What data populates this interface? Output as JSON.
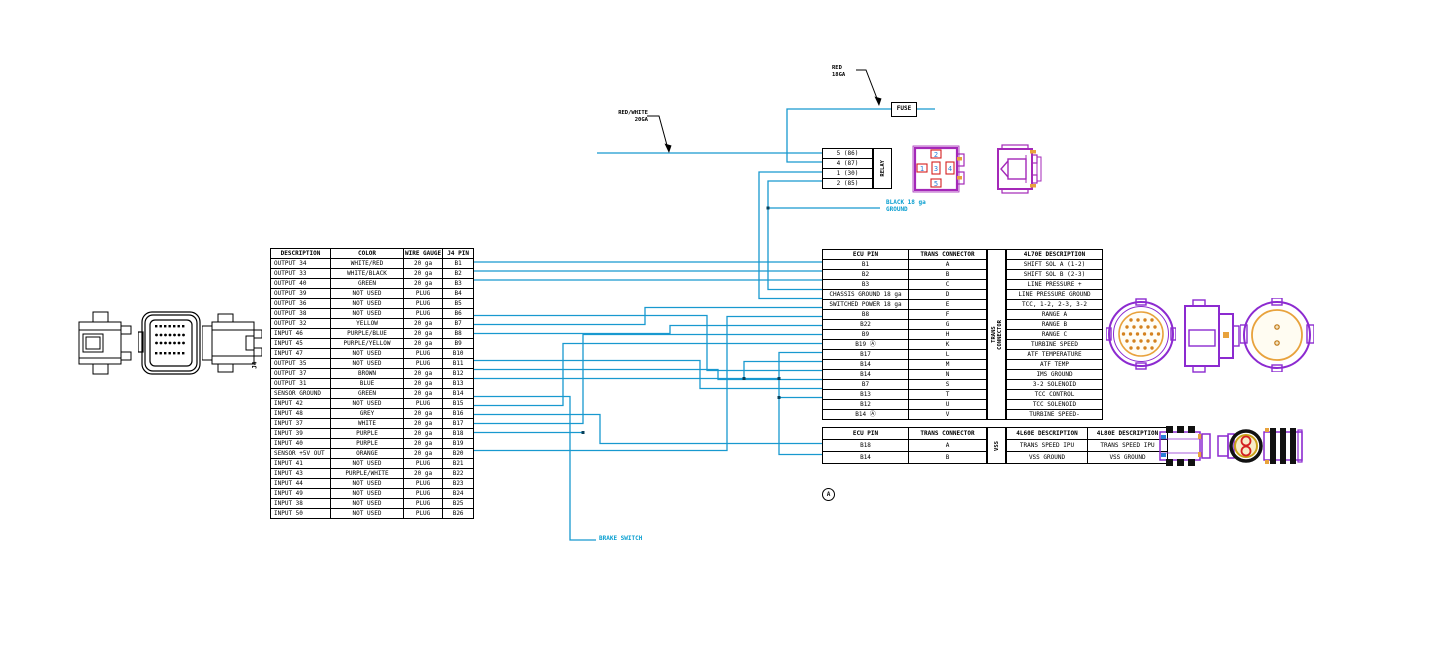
{
  "colors": {
    "wire_cyan": "#1899cf",
    "text_cyan": "#0a9fd0",
    "connector_purple": "#8c2ad0",
    "connector_magenta": "#a428b8",
    "accent_orange": "#e8a23c",
    "pin_red": "#d42020",
    "pin_blue": "#2b7fd8",
    "line_black": "#000000"
  },
  "labels": {
    "fuse": "FUSE",
    "relay": "RELAY",
    "brake_switch": "BRAKE SWITCH",
    "red_wire": "RED\n18GA",
    "red_white_wire": "RED/WHITE\n20GA",
    "ground": "BLACK 18 ga\nGROUND",
    "note_a": "A",
    "j4_label": "J4"
  },
  "relay": {
    "label": "RELAY",
    "rows": [
      [
        "5 (86)"
      ],
      [
        "4 (87)"
      ],
      [
        "1 (30)"
      ],
      [
        "2 (85)"
      ]
    ],
    "socket_pin_numbers": [
      "1",
      "2",
      "3",
      "4",
      "5"
    ]
  },
  "j4_table": {
    "headers": [
      "DESCRIPTION",
      "COLOR",
      "WIRE GAUGE",
      "J4 PIN"
    ],
    "rows": [
      [
        "OUTPUT 34",
        "WHITE/RED",
        "20 ga",
        "B1"
      ],
      [
        "OUTPUT 33",
        "WHITE/BLACK",
        "20 ga",
        "B2"
      ],
      [
        "OUTPUT 40",
        "GREEN",
        "20 ga",
        "B3"
      ],
      [
        "OUTPUT 39",
        "NOT USED",
        "PLUG",
        "B4"
      ],
      [
        "OUTPUT 36",
        "NOT USED",
        "PLUG",
        "B5"
      ],
      [
        "OUTPUT 38",
        "NOT USED",
        "PLUG",
        "B6"
      ],
      [
        "OUTPUT 32",
        "YELLOW",
        "20 ga",
        "B7"
      ],
      [
        "INPUT 46",
        "PURPLE/BLUE",
        "20 ga",
        "B8"
      ],
      [
        "INPUT 45",
        "PURPLE/YELLOW",
        "20 ga",
        "B9"
      ],
      [
        "INPUT 47",
        "NOT USED",
        "PLUG",
        "B10"
      ],
      [
        "OUTPUT 35",
        "NOT USED",
        "PLUG",
        "B11"
      ],
      [
        "OUTPUT 37",
        "BROWN",
        "20 ga",
        "B12"
      ],
      [
        "OUTPUT 31",
        "BLUE",
        "20 ga",
        "B13"
      ],
      [
        "SENSOR GROUND",
        "GREEN",
        "20 ga",
        "B14"
      ],
      [
        "INPUT 42",
        "NOT USED",
        "PLUG",
        "B15"
      ],
      [
        "INPUT 48",
        "GREY",
        "20 ga",
        "B16"
      ],
      [
        "INPUT 37",
        "WHITE",
        "20 ga",
        "B17"
      ],
      [
        "INPUT 39",
        "PURPLE",
        "20 ga",
        "B18"
      ],
      [
        "INPUT 40",
        "PURPLE",
        "20 ga",
        "B19"
      ],
      [
        "SENSOR +5V OUT",
        "ORANGE",
        "20 ga",
        "B20"
      ],
      [
        "INPUT 41",
        "NOT USED",
        "PLUG",
        "B21"
      ],
      [
        "INPUT 43",
        "PURPLE/WHITE",
        "20 ga",
        "B22"
      ],
      [
        "INPUT 44",
        "NOT USED",
        "PLUG",
        "B23"
      ],
      [
        "INPUT 49",
        "NOT USED",
        "PLUG",
        "B24"
      ],
      [
        "INPUT 38",
        "NOT USED",
        "PLUG",
        "B25"
      ],
      [
        "INPUT 50",
        "NOT USED",
        "PLUG",
        "B26"
      ]
    ]
  },
  "ecu_table": {
    "headers": [
      "ECU PIN",
      "TRANS CONNECTOR",
      "4L70E DESCRIPTION"
    ],
    "side_label": "TRANS\nCONNECTOR",
    "rows": [
      [
        "B1",
        "A",
        "SHIFT SOL A (1-2)"
      ],
      [
        "B2",
        "B",
        "SHIFT SOL B (2-3)"
      ],
      [
        "B3",
        "C",
        "LINE PRESSURE +"
      ],
      [
        "CHASSIS GROUND 18 ga",
        "D",
        "LINE PRESSURE GROUND"
      ],
      [
        "SWITCHED POWER 18 ga",
        "E",
        "TCC, 1-2, 2-3, 3-2"
      ],
      [
        "B8",
        "F",
        "RANGE A"
      ],
      [
        "B22",
        "G",
        "RANGE B"
      ],
      [
        "B9",
        "H",
        "RANGE C"
      ],
      [
        "B19 Ⓐ",
        "K",
        "TURBINE SPEED"
      ],
      [
        "B17",
        "L",
        "ATF TEMPERATURE"
      ],
      [
        "B14",
        "M",
        "ATF TEMP"
      ],
      [
        "B14",
        "N",
        "IMS GROUND"
      ],
      [
        "B7",
        "S",
        "3-2 SOLENOID"
      ],
      [
        "B13",
        "T",
        "TCC CONTROL"
      ],
      [
        "B12",
        "U",
        "TCC SOLENOID"
      ],
      [
        "B14 Ⓐ",
        "V",
        "TURBINE SPEED-"
      ]
    ]
  },
  "vss_table": {
    "headers": [
      "ECU PIN",
      "TRANS CONNECTOR",
      "4L60E DESCRIPTION",
      "4L80E DESCRIPTION"
    ],
    "side_label": "VSS",
    "rows": [
      [
        "B18",
        "A",
        "TRANS SPEED IPU",
        "TRANS SPEED IPU"
      ],
      [
        "B14",
        "B",
        "VSS GROUND",
        "VSS GROUND"
      ]
    ]
  }
}
